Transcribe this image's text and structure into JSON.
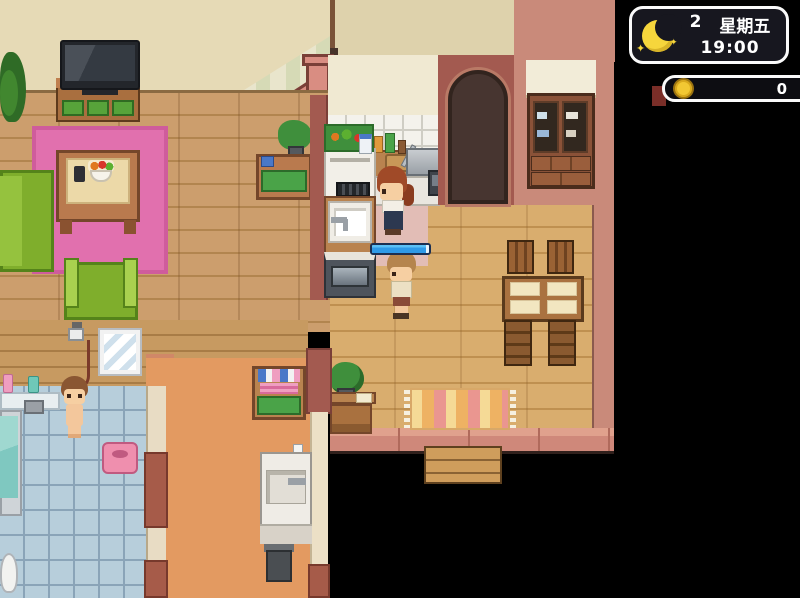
{
  "hud": {
    "time_panel": {
      "day_number": "2",
      "weekday": "星期五",
      "time": "19:00",
      "moon_icon": "crescent-moon-with-sparkles",
      "sparkle_glyph": "✦",
      "panel_bg": "#17171f",
      "border_color": "#fafafa",
      "moon_color": "#f6d63c"
    },
    "money_panel": {
      "amount": "0",
      "coin_icon": "gold-coin",
      "coin_color": "#f2c833",
      "panel_bg": "#0d0d12",
      "border_color": "#fafafa"
    }
  },
  "progress_bar": {
    "percent": 100,
    "fill_color": "#2f9ae8",
    "border_color": "#1b2f52"
  },
  "scene_palette": {
    "void": "#000000",
    "wall_beige": "#e6dab6",
    "wall_maroon": "#a35a50",
    "wall_salmon": "#c98a7a",
    "floor_living_wood": "#cc9e6d",
    "floor_dining_wood": "#d9ad6e",
    "floor_hallway": "#e39a61",
    "bathroom_tile": "#b7cedb",
    "rug_pink": "#e170ae",
    "kitchen_mat_pink": "#e2bdb6",
    "sofa_green": "#7fae2c",
    "stair_rail_salmon": "#d98d82"
  }
}
